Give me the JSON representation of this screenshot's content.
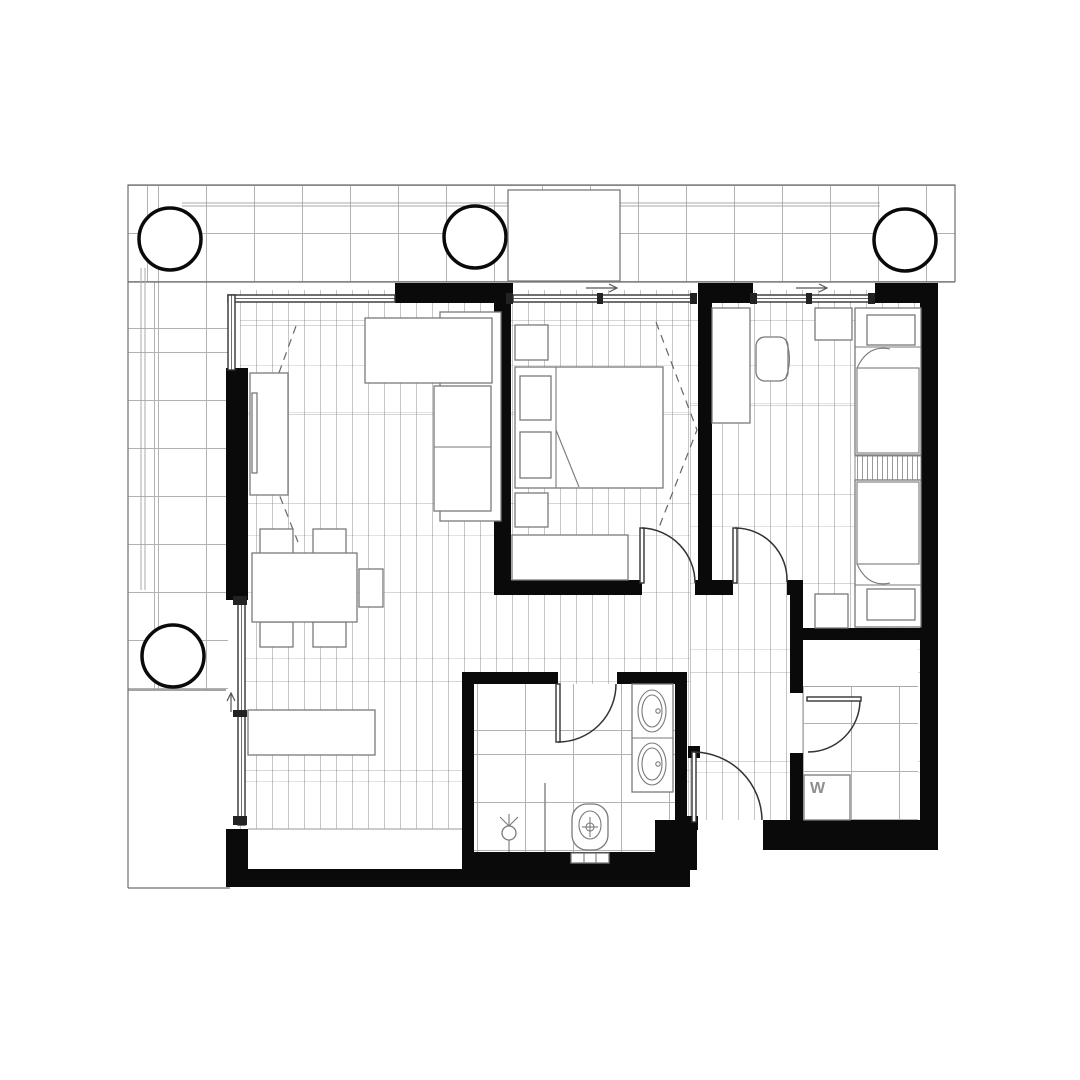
{
  "labels": {
    "washer": "W"
  },
  "colors": {
    "wall": "#0a0a0a",
    "outline": "#6e6e6e",
    "furniture-line": "#7a7a7a",
    "plank-line": "#c6c6c6",
    "tile-line": "#b2b2b2",
    "door-line": "#333333",
    "dash-line": "#666666",
    "label-text": "#8f8f8f",
    "background": "#ffffff"
  }
}
